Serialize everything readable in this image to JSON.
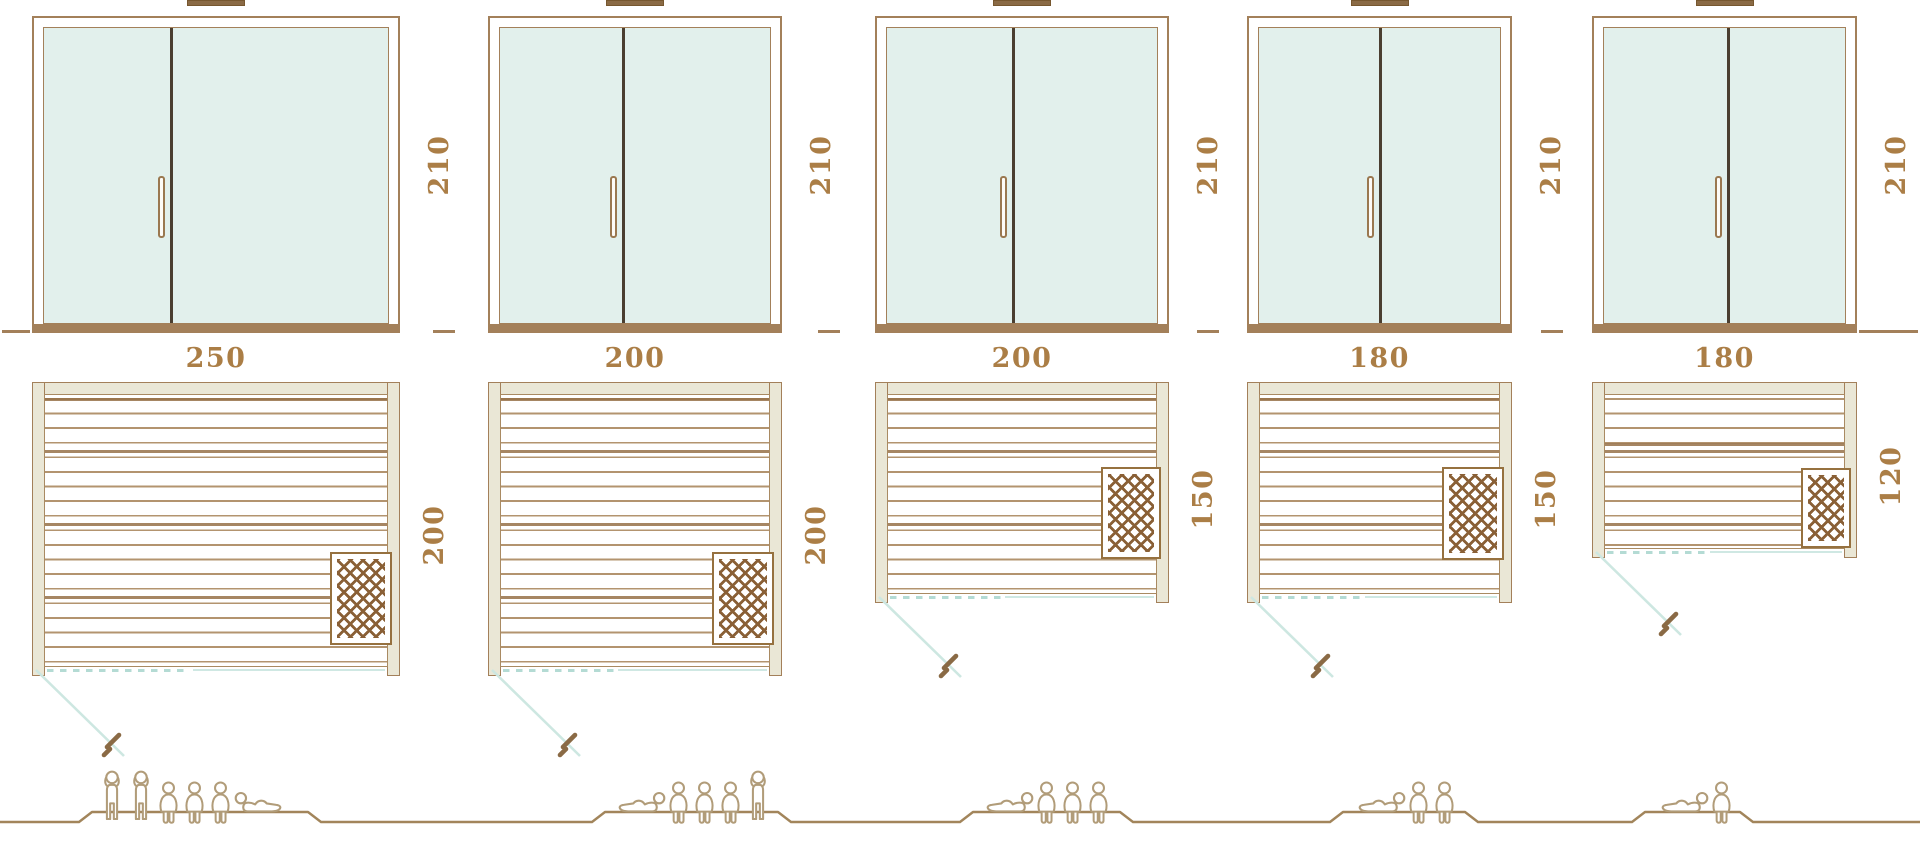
{
  "diagram_type": "sauna-size-comparison",
  "saunas": [
    {
      "name": "sauna-250x200",
      "door_height_cm": "210",
      "width_cm": "250",
      "depth_cm": "200",
      "capacity": 6,
      "figures": [
        "standing",
        "standing",
        "sitting",
        "sitting",
        "sitting",
        "lying-right"
      ]
    },
    {
      "name": "sauna-200x200",
      "door_height_cm": "210",
      "width_cm": "200",
      "depth_cm": "200",
      "capacity": 5,
      "figures": [
        "lying-left",
        "sitting",
        "sitting",
        "sitting",
        "standing"
      ]
    },
    {
      "name": "sauna-200x150",
      "door_height_cm": "210",
      "width_cm": "200",
      "depth_cm": "150",
      "capacity": 4,
      "figures": [
        "lying-left",
        "sitting",
        "sitting",
        "sitting"
      ]
    },
    {
      "name": "sauna-180x150",
      "door_height_cm": "210",
      "width_cm": "180",
      "depth_cm": "150",
      "capacity": 3,
      "figures": [
        "lying-left",
        "sitting",
        "sitting"
      ]
    },
    {
      "name": "sauna-180x120",
      "door_height_cm": "210",
      "width_cm": "180",
      "depth_cm": "120",
      "capacity": 2,
      "figures": [
        "lying-left",
        "sitting"
      ]
    }
  ],
  "colors": {
    "line_brown": "#a3805a",
    "plank_brown": "#b3946f",
    "dimension_text": "#ab7e46",
    "glass": "#e2f0ec",
    "wall_fill": "#eae7d6",
    "door_split": "#4a3e30",
    "heater": "#8a6036",
    "teal_track": "#b4dbd4",
    "swing_line": "#cde7e1",
    "figure_outline": "#b19c79",
    "ground_line": "#a2855b"
  }
}
